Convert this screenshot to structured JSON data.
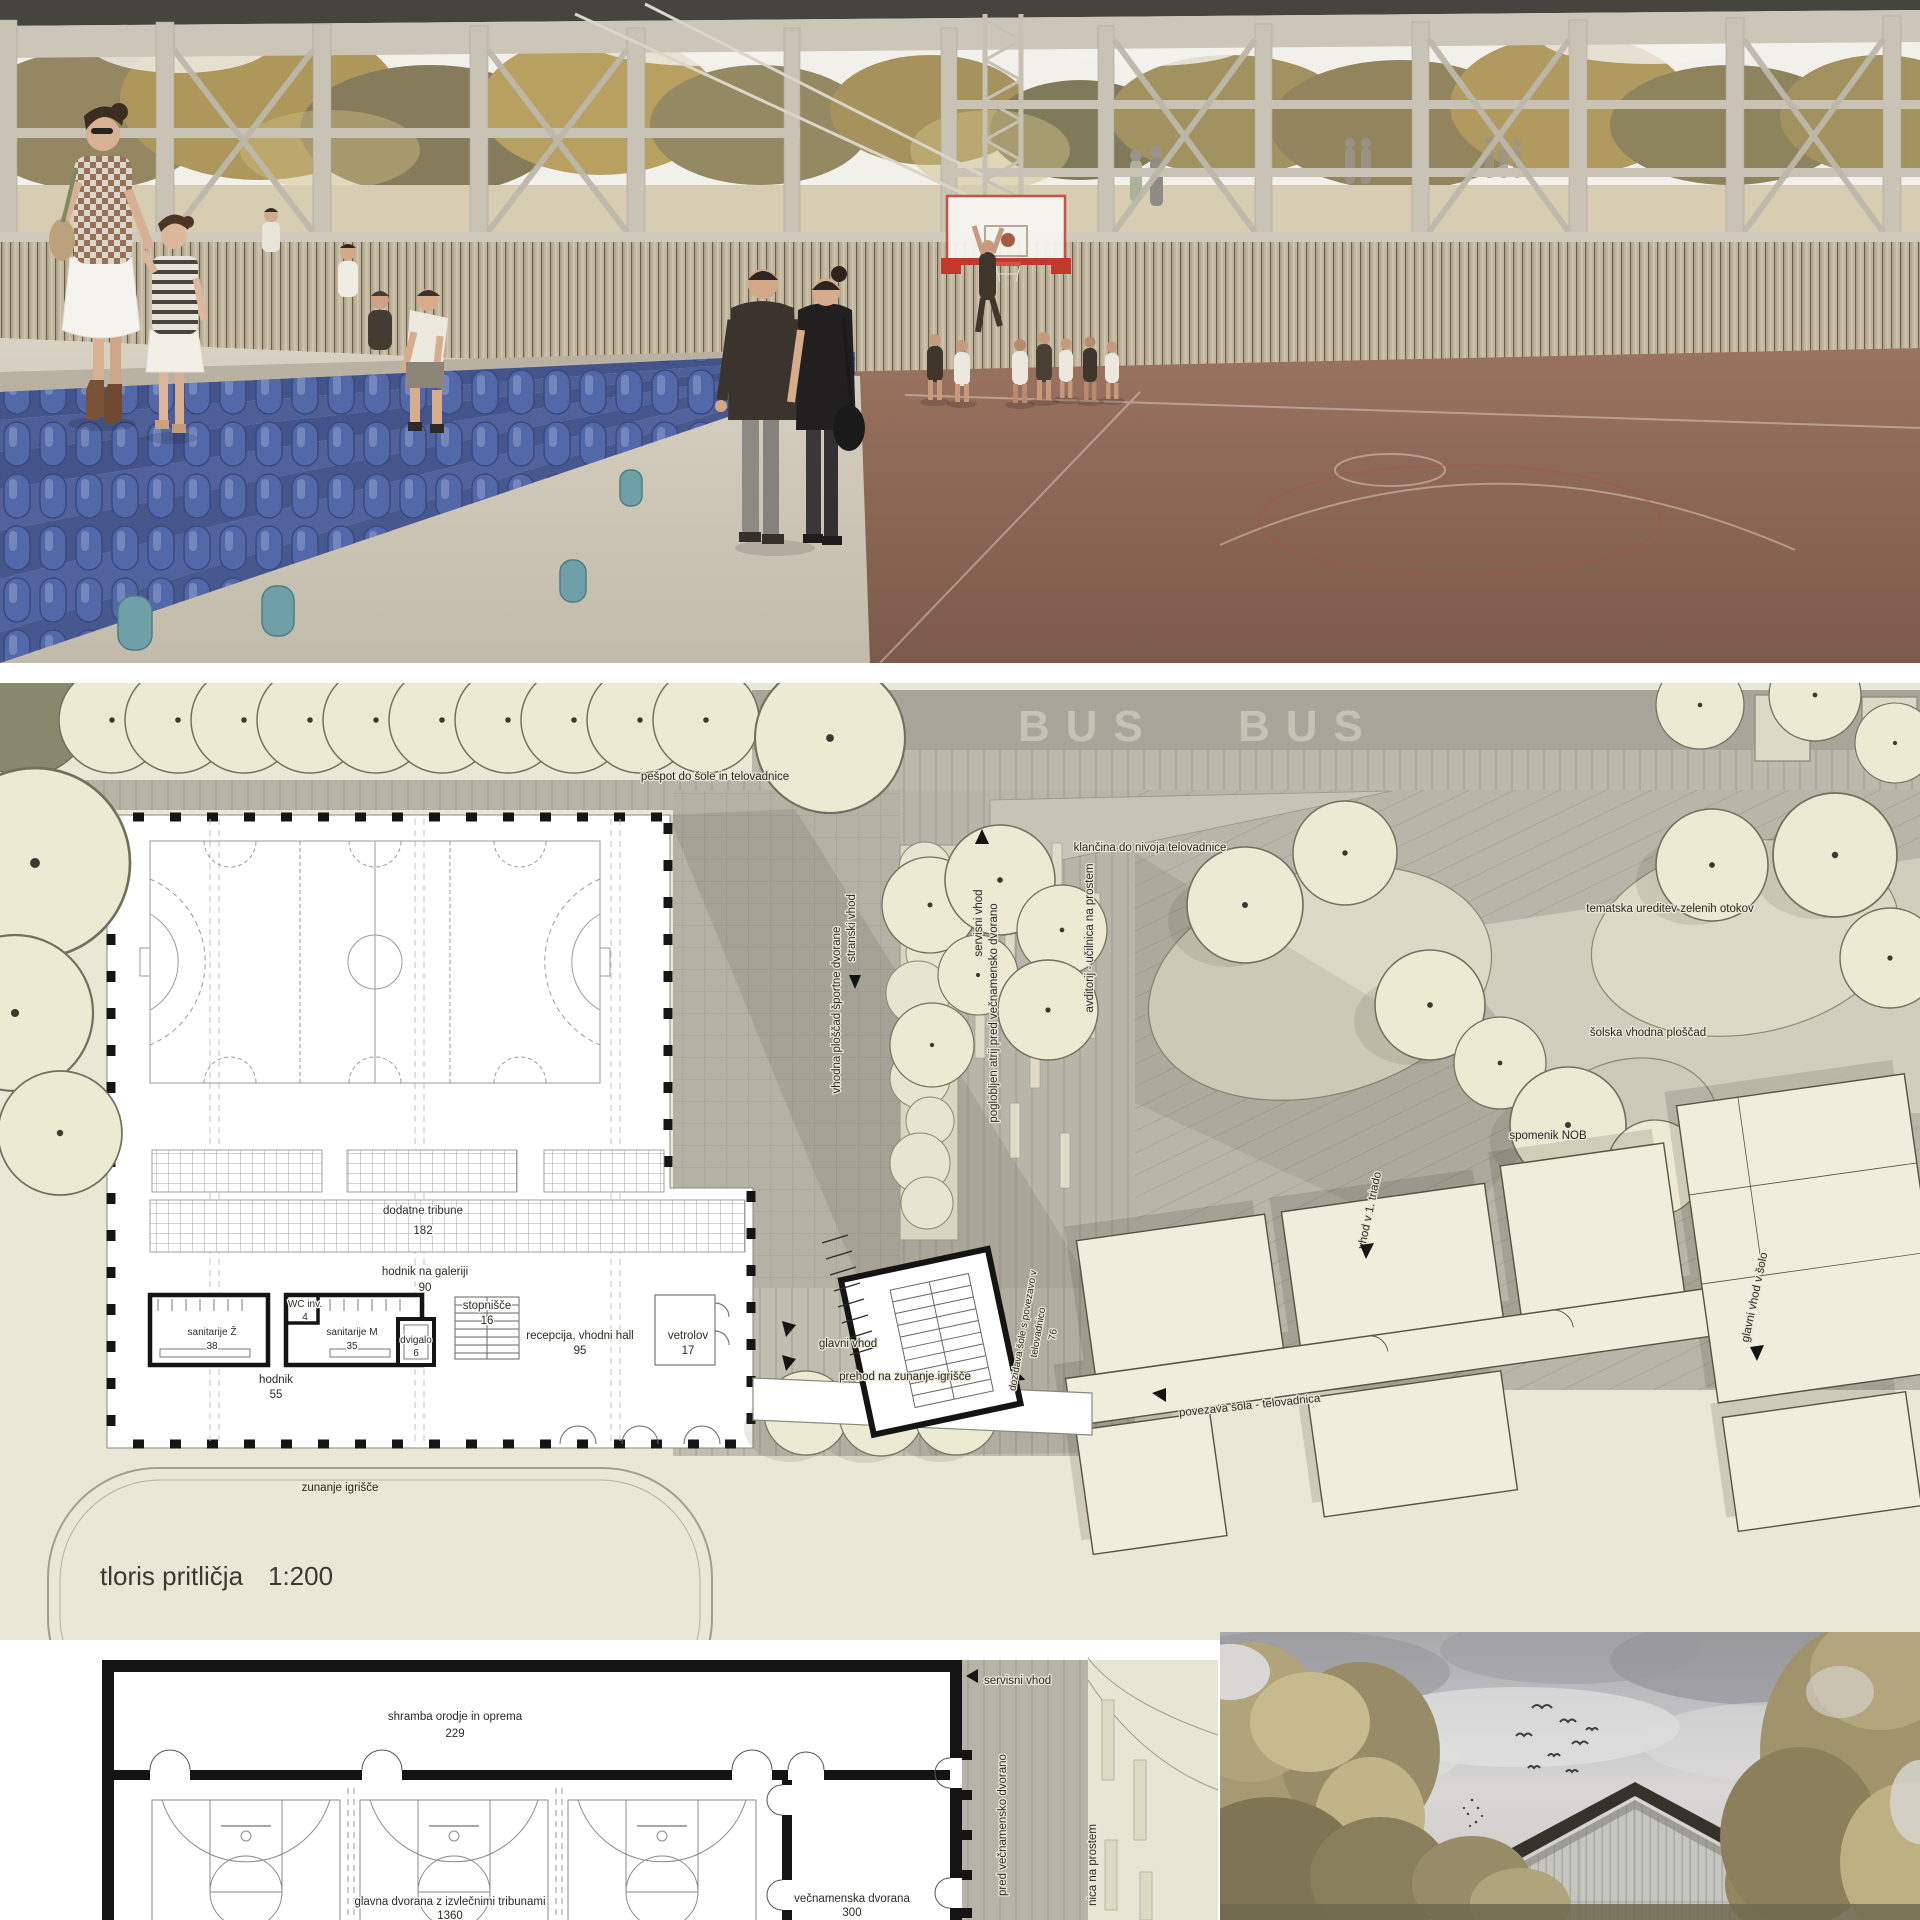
{
  "site_plan": {
    "caption": {
      "title": "tloris pritličja",
      "scale": "1:200"
    },
    "road": {
      "bus_left": "BUS",
      "bus_right": "BUS"
    },
    "labels": {
      "pespot": "pešpot do šole in telovadnice",
      "klancina": "klančina do nivoja telovadnice",
      "tematska": "tematska ureditev zelenih otokov",
      "solska_ploscad": "šolska vhodna ploščad",
      "spomenik": "spomenik NOB",
      "vhodna_ploscad": "vhodna ploščad športne dvorane",
      "servisni_vhod": "servisni vhod",
      "poglobljen_atrij": "poglobljen atrij pred večnamensko dvorano",
      "avditorij": "avditorij - učilnica na prostem",
      "stranski_vhod": "stranski vhod",
      "glavni_vhod": "glavni vhod",
      "prehod": "prehod na zunanje igrišče",
      "povezava": "povezava šola - telovadnica",
      "dozidava_line1": "dozidava šole s povezavo v",
      "dozidava_line2": "telovadnico",
      "dozidava_area": "76",
      "vhod_triada": "vhod v 1. triado",
      "glavni_vhod_sola": "glavni vhod v šolo",
      "zunanje": "zunanje igrišče"
    },
    "rooms": [
      {
        "name": "dodatne tribune",
        "area": "182"
      },
      {
        "name": "hodnik na galeriji",
        "area": "90"
      },
      {
        "name": "sanitarije Ž",
        "area": "38"
      },
      {
        "name": "WC inv.",
        "area": "4"
      },
      {
        "name": "sanitarije M",
        "area": "35"
      },
      {
        "name": "dvigalo",
        "area": "6"
      },
      {
        "name": "stopnišče",
        "area": "16"
      },
      {
        "name": "recepcija, vhodni hall",
        "area": "95"
      },
      {
        "name": "vetrolov",
        "area": "17"
      },
      {
        "name": "hodnik",
        "area": "55"
      }
    ]
  },
  "lower_plan": {
    "rooms": [
      {
        "name": "shramba orodje in oprema",
        "area": "229"
      },
      {
        "name": "glavna dvorana z izvlečnimi tribunami",
        "area": "1360"
      },
      {
        "name": "večnamenska dvorana",
        "area": "300"
      }
    ],
    "labels": {
      "servisni_vhod": "servisni vhod",
      "atrij_partial": "pred večnamensko dvorano",
      "ucilnica_partial": "nica na prostem"
    }
  },
  "palette": {
    "plan_background": "#e9e7d6",
    "paving_grey": "#b5b2a7",
    "tree_fill": "#ecead3",
    "seat_blue": "#5166a6",
    "court_brown": "#8f6553",
    "accent_red": "#c0392b",
    "sky_grey": "#b5b5b9"
  }
}
